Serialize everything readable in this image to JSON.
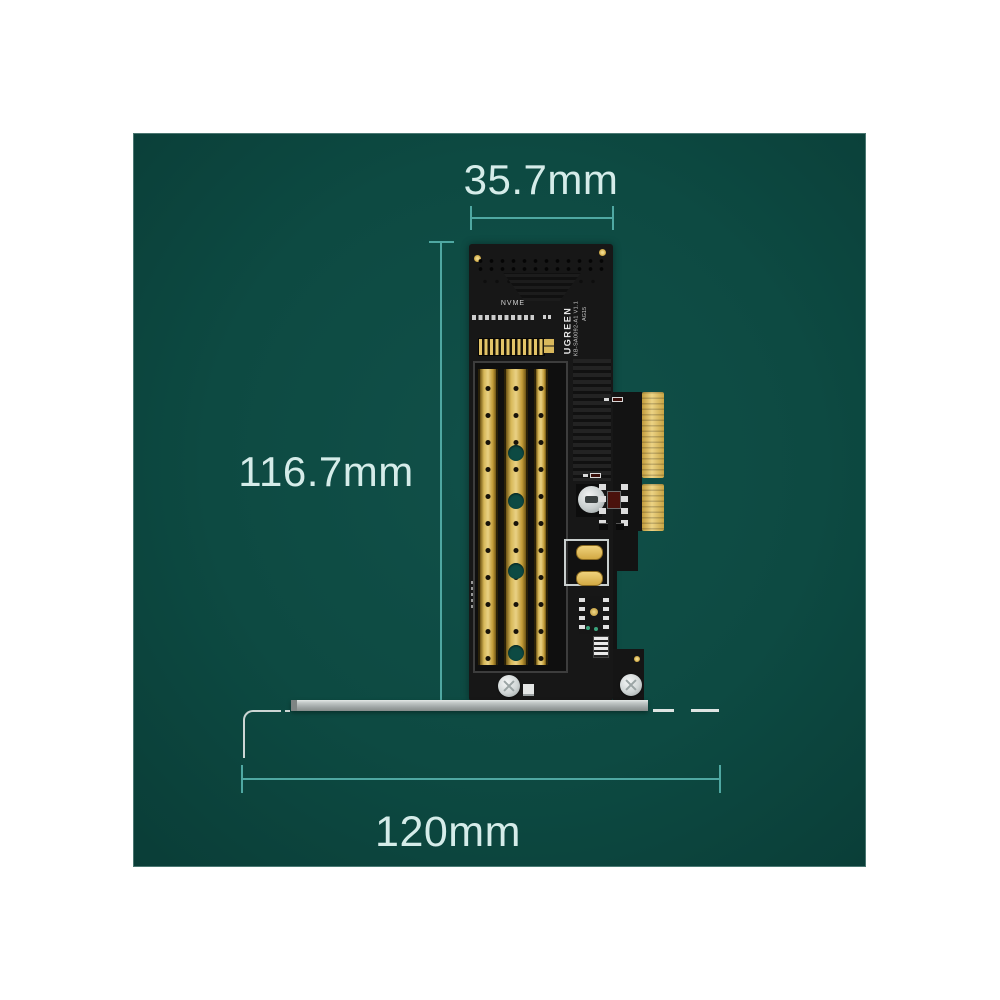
{
  "title": "PCIe adapter card dimension diagram",
  "dimensions": {
    "width": "35.7mm",
    "height": "116.7mm",
    "bracket_length": "120mm"
  },
  "card": {
    "slot_label": "NVME",
    "brand": "UGREEN",
    "model": "KB-SA0092-A1 V1.1",
    "batch": "AG15"
  },
  "colors": {
    "background": "#0d4a42",
    "dimension_line": "#4fa8a2",
    "dimension_text": "#d5ece9",
    "pcb_black": "#171717",
    "gold": "#d7b858",
    "bracket_silver": "#c2c8c7"
  }
}
